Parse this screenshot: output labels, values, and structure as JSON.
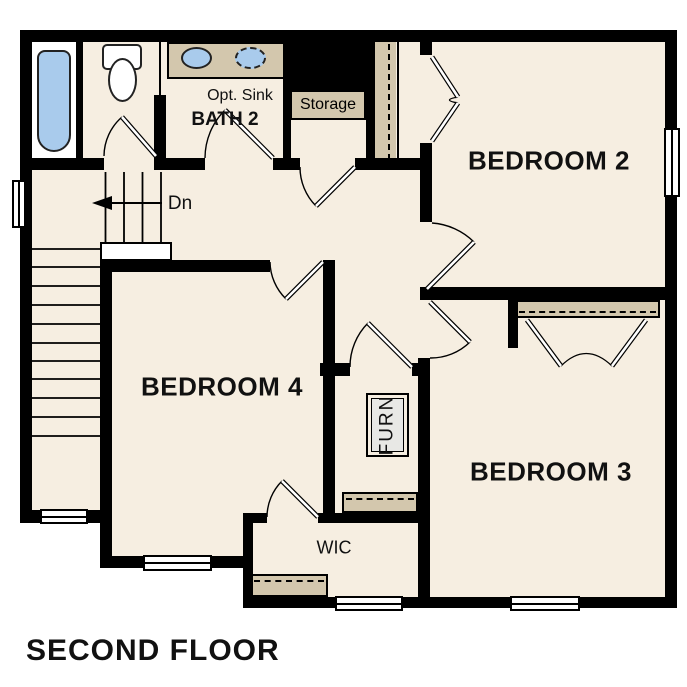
{
  "title": "SECOND FLOOR",
  "rooms": {
    "bedroom2": "BEDROOM 2",
    "bedroom3": "BEDROOM 3",
    "bedroom4": "BEDROOM 4",
    "bath2": "BATH 2",
    "wic": "WIC",
    "storage": "Storage",
    "furnace": "FURN"
  },
  "annotations": {
    "optional_sink": "Opt. Sink",
    "stair_direction": "Dn"
  },
  "icons": {
    "stair_direction_arrow": "left-arrow",
    "fixtures": [
      "bathtub",
      "toilet",
      "sink",
      "optional-sink-dashed"
    ]
  },
  "colors": {
    "floor": "#f6eee1",
    "casework_tan": "#d3c7ad",
    "fixture_blue": "#a9cbec",
    "wall": "#000000",
    "furnace_fill": "#e8e8e5",
    "background": "#ffffff"
  }
}
